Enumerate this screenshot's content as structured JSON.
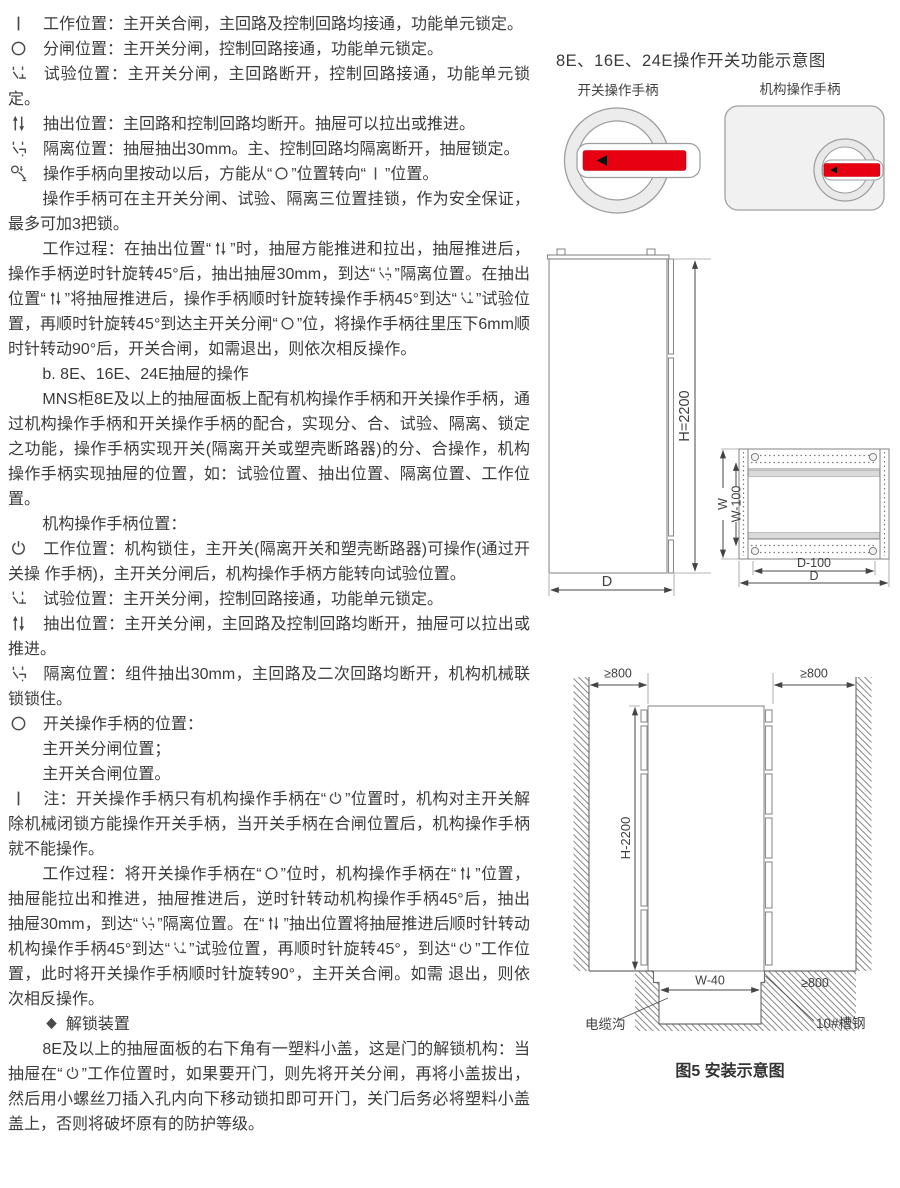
{
  "colors": {
    "red": "#e60012",
    "line": "#8c8c8c",
    "text": "#3b3b3b"
  },
  "left": {
    "blocks": [
      {
        "style": "item",
        "name": "work-position-item",
        "icon": "work-position-icon",
        "seg": [
          {
            "t": "工作位置：主开关合闸，主回路及控制回路均接通，功能单元锁定。"
          }
        ]
      },
      {
        "style": "item",
        "name": "open-position-item",
        "icon": "off-position-icon",
        "seg": [
          {
            "t": "分闸位置：主开关分闸，控制回路接通，功能单元锁定。"
          }
        ]
      },
      {
        "style": "item",
        "name": "test-position-item",
        "icon": "test-position-icon",
        "seg": [
          {
            "t": "试验位置：主开关分闸，主回路断开，控制回路接通，功能单元锁定。"
          }
        ]
      },
      {
        "style": "item",
        "name": "withdraw-position-item",
        "icon": "withdraw-position-icon",
        "seg": [
          {
            "t": "抽出位置：主回路和控制回路均断开。抽屉可以拉出或推进。"
          }
        ]
      },
      {
        "style": "item",
        "name": "isolation-position-item",
        "icon": "isolation-position-icon",
        "seg": [
          {
            "t": "隔离位置：抽屉抽出30mm。主、控制回路均隔离断开，抽屉锁定。"
          }
        ]
      },
      {
        "style": "item",
        "name": "handle-press-note",
        "icon": "handle-press-icon",
        "seg": [
          {
            "t": "操作手柄向里按动以后，方能从“"
          },
          {
            "ic": "off-position-icon"
          },
          {
            "t": "”位置转向“"
          },
          {
            "ic": "work-position-icon"
          },
          {
            "t": "”位置。"
          }
        ]
      },
      {
        "style": "para",
        "name": "padlock-note",
        "seg": [
          {
            "t": "操作手柄可在主开关分闸、试验、隔离三位置挂锁，作为安全保证，最多可加3把锁。"
          }
        ]
      },
      {
        "style": "para",
        "name": "work-process-a",
        "seg": [
          {
            "t": "工作过程：在抽出位置“"
          },
          {
            "ic": "withdraw-position-icon"
          },
          {
            "t": "”时，抽屉方能推进和拉出，抽屉推进后，操作手柄逆时针旋转45°后，抽出抽屉30mm，到达“"
          },
          {
            "ic": "isolation-position-icon"
          },
          {
            "t": "”隔离位置。在抽出位置“"
          },
          {
            "ic": "withdraw-position-icon"
          },
          {
            "t": "”将抽屉推进后，操作手柄顺时针旋转操作手柄45°到达“"
          },
          {
            "ic": "test-position-icon"
          },
          {
            "t": "”试验位置，再顺时针旋转45°到达主开关分闸“"
          },
          {
            "ic": "off-position-icon"
          },
          {
            "t": "”位，将操作手柄往里压下6mm顺时针转动90°后，开关合闸，如需退出，则依次相反操作。"
          }
        ]
      },
      {
        "style": "head",
        "name": "section-b-heading",
        "seg": [
          {
            "t": "b. 8E、16E、24E抽屉的操作"
          }
        ]
      },
      {
        "style": "para",
        "name": "mns-intro",
        "seg": [
          {
            "t": "MNS柜8E及以上的抽屉面板上配有机构操作手柄和开关操作手柄，通过机构操作手柄和开关操作手柄的配合，实现分、合、试验、隔离、锁定之功能，操作手柄实现开关(隔离开关或塑壳断路器)的分、合操作，机构操作手柄实现抽屉的位置，如：试验位置、抽出位置、隔离位置、工作位置。"
          }
        ]
      },
      {
        "style": "sub",
        "name": "mech-handle-positions-heading",
        "seg": [
          {
            "t": "机构操作手柄位置："
          }
        ]
      },
      {
        "style": "item",
        "name": "mech-work-position-item",
        "icon": "power-position-icon",
        "seg": [
          {
            "t": "工作位置：机构锁住，主开关(隔离开关和塑壳断路器)可操作(通过开关操 作手柄)，主开关分闸后，机构操作手柄方能转向试验位置。"
          }
        ]
      },
      {
        "style": "item",
        "name": "mech-test-position-item",
        "icon": "test-position-icon",
        "seg": [
          {
            "t": "试验位置：主开关分闸，控制回路接通，功能单元锁定。"
          }
        ]
      },
      {
        "style": "item",
        "name": "mech-withdraw-position-item",
        "icon": "withdraw-position-icon",
        "seg": [
          {
            "t": "抽出位置：主开关分闸，主回路及控制回路均断开，抽屉可以拉出或推进。"
          }
        ]
      },
      {
        "style": "item",
        "name": "mech-isolation-position-item",
        "icon": "isolation-position-icon",
        "seg": [
          {
            "t": "隔离位置：组件抽出30mm，主回路及二次回路均断开，机构机械联锁锁住。"
          }
        ]
      },
      {
        "style": "item",
        "name": "switch-handle-positions-heading",
        "icon": "off-position-icon",
        "seg": [
          {
            "t": "开关操作手柄的位置："
          }
        ]
      },
      {
        "style": "line",
        "name": "switch-open-line",
        "seg": [
          {
            "t": "主开关分闸位置；"
          }
        ]
      },
      {
        "style": "line",
        "name": "switch-close-line",
        "seg": [
          {
            "t": "主开关合闸位置。"
          }
        ]
      },
      {
        "style": "item",
        "name": "note-item",
        "icon": "work-position-icon",
        "seg": [
          {
            "t": "注：开关操作手柄只有机构操作手柄在“"
          },
          {
            "ic": "power-position-icon"
          },
          {
            "t": "”位置时，机构对主开关解除机械闭锁方能操作开关手柄，当开关手柄在合闸位置后，机构操作手柄就不能操作。"
          }
        ]
      },
      {
        "style": "para",
        "name": "work-process-b",
        "seg": [
          {
            "t": "工作过程：将开关操作手柄在“"
          },
          {
            "ic": "off-position-icon"
          },
          {
            "t": "”位时，机构操作手柄在“"
          },
          {
            "ic": "withdraw-position-icon"
          },
          {
            "t": "”位置，抽屉能拉出和推进，抽屉推进后，逆时针转动机构操作手柄45°后，抽出 抽屉30mm，到达“"
          },
          {
            "ic": "isolation-position-icon"
          },
          {
            "t": "”隔离位置。在“"
          },
          {
            "ic": "withdraw-position-icon"
          },
          {
            "t": "”抽出位置将抽屉推进后顺时针转动机构操作手柄45°到达“"
          },
          {
            "ic": "test-position-icon"
          },
          {
            "t": "”试验位置，再顺时针旋转45°，到达“"
          },
          {
            "ic": "power-position-icon"
          },
          {
            "t": "”工作位置，此时将开关操作手柄顺时针旋转90°，主开关合闸。如需 退出，则依次相反操作。"
          }
        ]
      },
      {
        "style": "mark",
        "name": "unlock-device-heading",
        "seg": [
          {
            "ic": "diamond-icon"
          },
          {
            "t": " 解锁装置"
          }
        ]
      },
      {
        "style": "para",
        "name": "unlock-device-para",
        "seg": [
          {
            "t": "8E及以上的抽屉面板的右下角有一塑料小盖，这是门的解锁机构：当抽屉在“"
          },
          {
            "ic": "power-position-icon"
          },
          {
            "t": "”工作位置时，如果要开门，则先将开关分闸，再将小盖拔出，然后用小螺丝刀插入孔内向下移动锁扣即可开门，关门后务必将塑料小盖盖上，否则将破坏原有的防护等级。"
          }
        ]
      }
    ]
  },
  "fig": {
    "title": "8E、16E、24E操作开关功能示意图",
    "switch_handle_label": "开关操作手柄",
    "mech_handle_label": "机构操作手柄"
  },
  "cabinet": {
    "h": "H=2200",
    "d_front": "D",
    "w": "W",
    "w100": "W-100",
    "d100": "D-100",
    "d_plan": "D"
  },
  "install": {
    "ge800": "≥800",
    "h": "H-2200",
    "w40": "W-40",
    "cable_trench": "电缆沟",
    "channel_steel": "10#槽钢",
    "caption": "图5 安装示意图"
  }
}
